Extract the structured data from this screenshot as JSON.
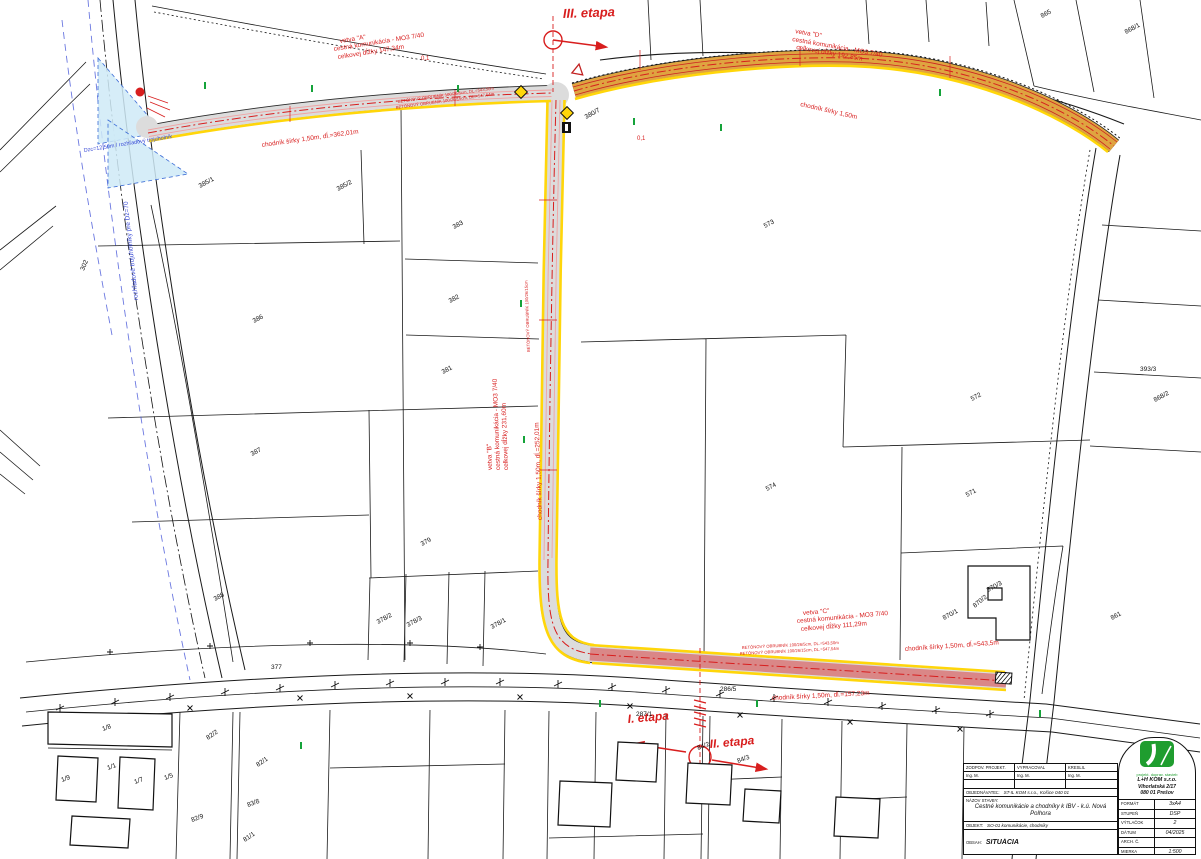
{
  "colors": {
    "red": "#d81e1e",
    "blue": "#3a4bd6",
    "black": "#111111",
    "green": "#15a33a",
    "road_gray": "#dcdcdc",
    "stage3_orange": "#dfa440",
    "sidewalk_yellow": "#ffd60a",
    "sight_blue": "#cfeaf7",
    "logo_green": "#1f9d2f"
  },
  "annotations": [
    {
      "t": "III. etapa",
      "x": 563,
      "y": 18,
      "r": -2,
      "s": 13,
      "c": "red",
      "i": true,
      "n": "stage-3-label"
    },
    {
      "t": "vetva \"A\"",
      "x": 340,
      "y": 43,
      "r": -9,
      "c": "red"
    },
    {
      "t": "cestná komunikácia - MO3 7/40",
      "x": 334,
      "y": 51,
      "r": -9,
      "c": "red"
    },
    {
      "t": "celkovej dĺžky 147,34m",
      "x": 338,
      "y": 59,
      "r": -9,
      "c": "red"
    },
    {
      "t": "vetva \"D\"",
      "x": 795,
      "y": 33,
      "r": 10,
      "c": "red"
    },
    {
      "t": "cestná komunikácia - MO3 7/40",
      "x": 792,
      "y": 41,
      "r": 10,
      "c": "red"
    },
    {
      "t": "celkovej dĺžky 192,85m",
      "x": 796,
      "y": 49,
      "r": 10,
      "c": "red"
    },
    {
      "t": "chodník šírky 1,50m, dĺ.=362,01m",
      "x": 262,
      "y": 147,
      "r": -8,
      "c": "red"
    },
    {
      "t": "BETÓNOVÝ OBRUBNÍK 100/26/5cm, DL.=543,50m",
      "x": 398,
      "y": 103,
      "r": -8,
      "s": 4.2,
      "c": "red"
    },
    {
      "t": "BETÓNOVÝ OBRUBNÍK 100/26/15cm, DL.=547,54m",
      "x": 396,
      "y": 109,
      "r": -8,
      "s": 4.2,
      "c": "red"
    },
    {
      "t": "chodník šírky 1,50m",
      "x": 800,
      "y": 106,
      "r": 13,
      "c": "red"
    },
    {
      "t": "vetva \"B\"",
      "x": 492,
      "y": 470,
      "r": -92,
      "c": "red"
    },
    {
      "t": "cestná komunikácia - MO3 7/40",
      "x": 500,
      "y": 470,
      "r": -92,
      "c": "red"
    },
    {
      "t": "celkovej dĺžky 231,60m",
      "x": 508,
      "y": 470,
      "r": -92,
      "c": "red"
    },
    {
      "t": "chodník šírky 1,50m, dĺ.=252,01m",
      "x": 542,
      "y": 520,
      "r": -92,
      "c": "red"
    },
    {
      "t": "BETÓNOVÝ OBRUBNÍK 100/26/15cm",
      "x": 530,
      "y": 352,
      "r": -92,
      "s": 4.2,
      "c": "red"
    },
    {
      "t": "vetva \"C\"",
      "x": 803,
      "y": 615,
      "r": -5,
      "c": "red"
    },
    {
      "t": "cestná komunikácia - MO3 7/40",
      "x": 797,
      "y": 623,
      "r": -5,
      "c": "red"
    },
    {
      "t": "celkovej dĺžky 111,29m",
      "x": 801,
      "y": 631,
      "r": -5,
      "c": "red"
    },
    {
      "t": "BETÓNOVÝ OBRUBNÍK 100/26/5cm, DL.=543,50m",
      "x": 742,
      "y": 649,
      "r": -3,
      "s": 4.2,
      "c": "red"
    },
    {
      "t": "BETÓNOVÝ OBRUBNÍK 100/26/15cm, DL.=547,54m",
      "x": 740,
      "y": 655,
      "r": -3,
      "s": 4.2,
      "c": "red"
    },
    {
      "t": "chodník šírky 1,50m, dĺ.=543,5m",
      "x": 905,
      "y": 651,
      "r": -4,
      "c": "red"
    },
    {
      "t": "chodník šírky 1,50m, dĺ.=157,23m",
      "x": 772,
      "y": 700,
      "r": -3,
      "c": "red"
    },
    {
      "t": "I. etapa",
      "x": 628,
      "y": 723,
      "r": -5,
      "s": 12,
      "c": "red",
      "i": true,
      "n": "stage-1-label"
    },
    {
      "t": "II. etapa",
      "x": 710,
      "y": 748,
      "r": -5,
      "s": 12,
      "c": "red",
      "i": true,
      "n": "stage-2-label"
    },
    {
      "t": "rozhľadové trojuholníky pre Dz=70",
      "x": 138,
      "y": 300,
      "r": -96,
      "c": "blue"
    },
    {
      "t": "Dzc=12,50m / rozhľadový trojuholník",
      "x": 84,
      "y": 152,
      "r": -9,
      "s": 5.5,
      "c": "blue"
    },
    {
      "t": "0,1",
      "x": 421,
      "y": 60,
      "s": 6,
      "c": "red"
    },
    {
      "t": "0,1",
      "x": 637,
      "y": 140,
      "s": 6,
      "c": "red"
    }
  ],
  "parcels": [
    {
      "t": "385/1",
      "x": 200,
      "y": 188,
      "r": -28
    },
    {
      "t": "385/2",
      "x": 338,
      "y": 191,
      "r": -28
    },
    {
      "t": "383",
      "x": 454,
      "y": 229,
      "r": -28
    },
    {
      "t": "382",
      "x": 450,
      "y": 303,
      "r": -28
    },
    {
      "t": "381",
      "x": 443,
      "y": 374,
      "r": -28
    },
    {
      "t": "386",
      "x": 254,
      "y": 323,
      "r": -28
    },
    {
      "t": "387",
      "x": 252,
      "y": 456,
      "r": -28
    },
    {
      "t": "388",
      "x": 215,
      "y": 601,
      "r": -28
    },
    {
      "t": "379",
      "x": 422,
      "y": 546,
      "r": -28
    },
    {
      "t": "378/2",
      "x": 378,
      "y": 624,
      "r": -28
    },
    {
      "t": "378/3",
      "x": 408,
      "y": 627,
      "r": -28
    },
    {
      "t": "378/1",
      "x": 492,
      "y": 629,
      "r": -28
    },
    {
      "t": "380/7",
      "x": 586,
      "y": 119,
      "r": -28
    },
    {
      "t": "573",
      "x": 765,
      "y": 228,
      "r": -28
    },
    {
      "t": "574",
      "x": 767,
      "y": 491,
      "r": -28
    },
    {
      "t": "572",
      "x": 972,
      "y": 401,
      "r": -28
    },
    {
      "t": "571",
      "x": 967,
      "y": 497,
      "r": -28
    },
    {
      "t": "868/2",
      "x": 1155,
      "y": 402,
      "r": -28
    },
    {
      "t": "393/3",
      "x": 1140,
      "y": 371,
      "r": 0
    },
    {
      "t": "870/3",
      "x": 988,
      "y": 592,
      "r": -28
    },
    {
      "t": "870/2",
      "x": 975,
      "y": 608,
      "r": -40
    },
    {
      "t": "870/1",
      "x": 944,
      "y": 620,
      "r": -28
    },
    {
      "t": "861",
      "x": 1112,
      "y": 620,
      "r": -28
    },
    {
      "t": "865",
      "x": 1042,
      "y": 18,
      "r": -28
    },
    {
      "t": "868/1",
      "x": 1126,
      "y": 34,
      "r": -28
    },
    {
      "t": "302",
      "x": 84,
      "y": 271,
      "r": -68
    },
    {
      "t": "1/8",
      "x": 103,
      "y": 731,
      "r": -20
    },
    {
      "t": "1/1",
      "x": 108,
      "y": 770,
      "r": -20
    },
    {
      "t": "1/7",
      "x": 135,
      "y": 784,
      "r": -20
    },
    {
      "t": "1/5",
      "x": 165,
      "y": 780,
      "r": -20
    },
    {
      "t": "1/9",
      "x": 62,
      "y": 782,
      "r": -20
    },
    {
      "t": "82/2",
      "x": 208,
      "y": 740,
      "r": -35
    },
    {
      "t": "82/1",
      "x": 258,
      "y": 767,
      "r": -35
    },
    {
      "t": "82/9",
      "x": 192,
      "y": 822,
      "r": -20
    },
    {
      "t": "83/8",
      "x": 248,
      "y": 807,
      "r": -20
    },
    {
      "t": "81/1",
      "x": 245,
      "y": 842,
      "r": -35
    },
    {
      "t": "84/2",
      "x": 698,
      "y": 750,
      "r": -20
    },
    {
      "t": "84/3",
      "x": 738,
      "y": 763,
      "r": -20
    },
    {
      "t": "287/1",
      "x": 636,
      "y": 716,
      "r": 0
    },
    {
      "t": "377",
      "x": 271,
      "y": 669,
      "r": 0
    },
    {
      "t": "286/5",
      "x": 720,
      "y": 691,
      "r": 0
    }
  ],
  "title_block": {
    "row1": [
      "ZODPOV. PROJEKT.",
      "VYPRACOVAL",
      "KRESLIL"
    ],
    "row2": [
      "Ing. M.",
      "Ing. M.",
      "Ing. M."
    ],
    "investor_label": "OBJEDNÁVATEĽ:",
    "investor": "ST-IL KOM s.r.o., Košice 040 01",
    "project_label": "NÁZOV STAVBY:",
    "project": "Cestné komunikácie a chodníky k IBV - k.ú. Nová Polhora",
    "object_label": "OBJEKT:",
    "object": "SO-01 komunikácie, chodníky",
    "content_label": "OBSAH:",
    "content": "SITUÁCIA",
    "company": {
      "tagline": "projekt. doprav. stavieb",
      "name": "L+H KOM s.r.o.",
      "street": "Vihorlatská 2/17",
      "city": "080 01 Prešov"
    },
    "meta": [
      [
        "FORMÁT",
        "3xA4"
      ],
      [
        "STUPEŇ",
        "DSP"
      ],
      [
        "VÝTLAČOK",
        "2"
      ],
      [
        "DÁTUM",
        "04/2025"
      ],
      [
        "ARCH. Č.",
        ""
      ],
      [
        "MIERKA",
        "1:500"
      ]
    ]
  }
}
